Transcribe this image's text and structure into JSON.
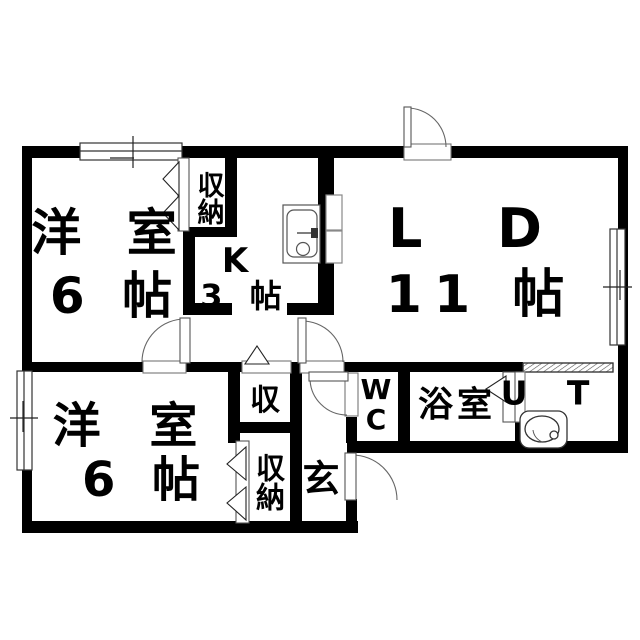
{
  "plan": {
    "type": "apartment-floor-plan",
    "rooms": {
      "bedroom_upper": {
        "label": "洋 室",
        "size": "6 帖"
      },
      "kitchen": {
        "label": "K",
        "size": "3 帖"
      },
      "living_dining": {
        "label": "L D",
        "size": "11 帖"
      },
      "bedroom_lower": {
        "label": "洋 室",
        "size": "6 帖"
      },
      "closet_upper": {
        "label": "収納"
      },
      "closet_mid": {
        "label": "収"
      },
      "closet_lower": {
        "label": "収納"
      },
      "entrance": {
        "label": "玄"
      },
      "wc": {
        "label_line1": "W",
        "label_line2": "C"
      },
      "bathroom": {
        "label": "浴室"
      },
      "utility": {
        "label": "U T"
      }
    },
    "fixtures": {
      "kitchen_sink": "kitchen-sink-icon",
      "washbasin": "washbasin-icon"
    },
    "colors": {
      "wall": "#000000",
      "background": "#ffffff",
      "line": "#555555"
    }
  }
}
